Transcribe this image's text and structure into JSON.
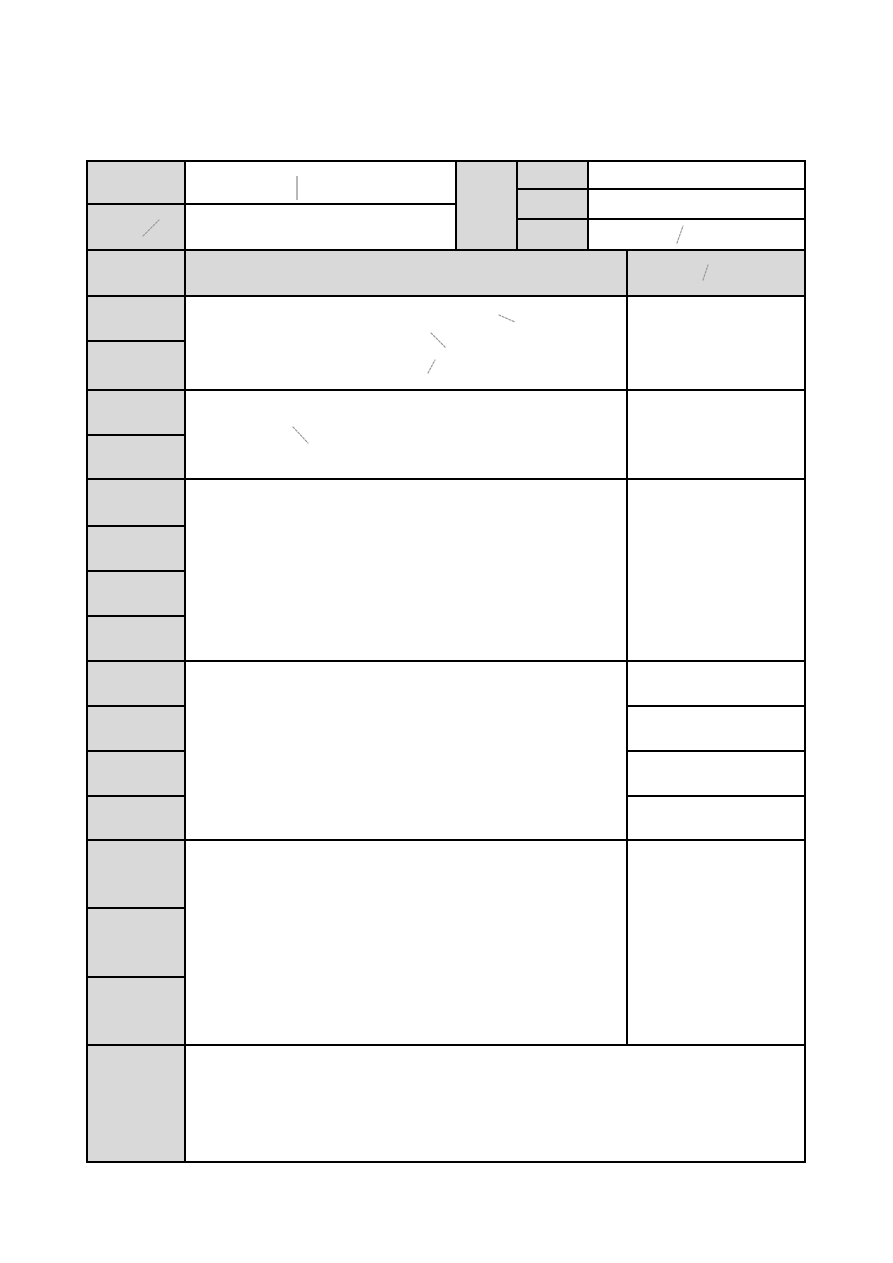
{
  "colors": {
    "page_background": "#ffffff",
    "label_cell": "#d9d9d9",
    "field_cell": "#ffffff",
    "grid_line": "#000000",
    "mark": "#999999"
  },
  "marks": [
    {
      "name": "text-cursor-mark",
      "type": "bar",
      "x1": 297,
      "y1": 176,
      "x2": 297,
      "y2": 200
    },
    {
      "name": "pen-stroke",
      "type": "stroke",
      "x1": 143,
      "y1": 236,
      "x2": 159,
      "y2": 220
    },
    {
      "name": "pen-stroke",
      "type": "stroke",
      "x1": 677,
      "y1": 243,
      "x2": 683,
      "y2": 226
    },
    {
      "name": "pen-stroke",
      "type": "stroke",
      "x1": 703,
      "y1": 280,
      "x2": 708,
      "y2": 265
    },
    {
      "name": "pen-stroke",
      "type": "stroke",
      "x1": 499,
      "y1": 315,
      "x2": 515,
      "y2": 322
    },
    {
      "name": "pen-stroke",
      "type": "stroke",
      "x1": 431,
      "y1": 333,
      "x2": 446,
      "y2": 348
    },
    {
      "name": "pen-stroke",
      "type": "stroke",
      "x1": 428,
      "y1": 373,
      "x2": 435,
      "y2": 360
    },
    {
      "name": "pen-stroke",
      "type": "stroke",
      "x1": 293,
      "y1": 427,
      "x2": 308,
      "y2": 443
    }
  ]
}
